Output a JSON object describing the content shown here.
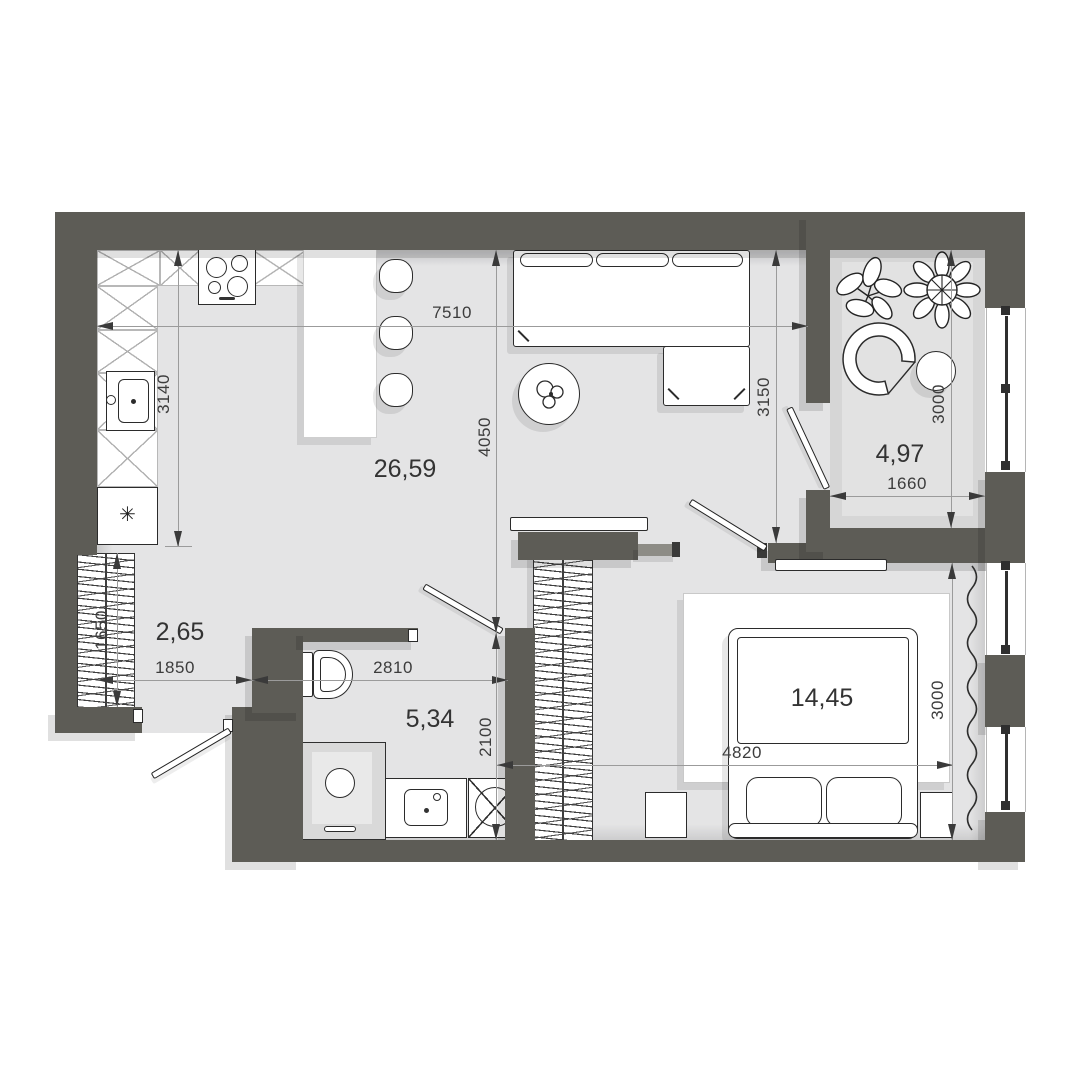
{
  "title": "Apartment floor plan",
  "rooms": {
    "living_kitchen": {
      "area": "26,59"
    },
    "balcony": {
      "area": "4,97"
    },
    "hallway": {
      "area": "2,65"
    },
    "bathroom": {
      "area": "5,34"
    },
    "bedroom": {
      "area": "14,45"
    }
  },
  "dimensions_mm": {
    "overall_width": "7510",
    "kitchen_depth": "3140",
    "living_depth": "4050",
    "living_right_depth": "3150",
    "balcony_depth": "3000",
    "balcony_width": "1660",
    "hall_closet_width": "1650",
    "hallway_width": "1850",
    "bathroom_width": "2810",
    "bathroom_depth": "2100",
    "bedroom_width": "4820",
    "bedroom_depth": "3000"
  },
  "icons": {
    "fridge_glyph": "✳"
  },
  "colors": {
    "wall": "#5d5c56",
    "floor": "#e4e4e5",
    "balcony_floor": "#d6d6d6",
    "outline": "#2b2b2b",
    "dim_text": "#3c3c3c"
  }
}
